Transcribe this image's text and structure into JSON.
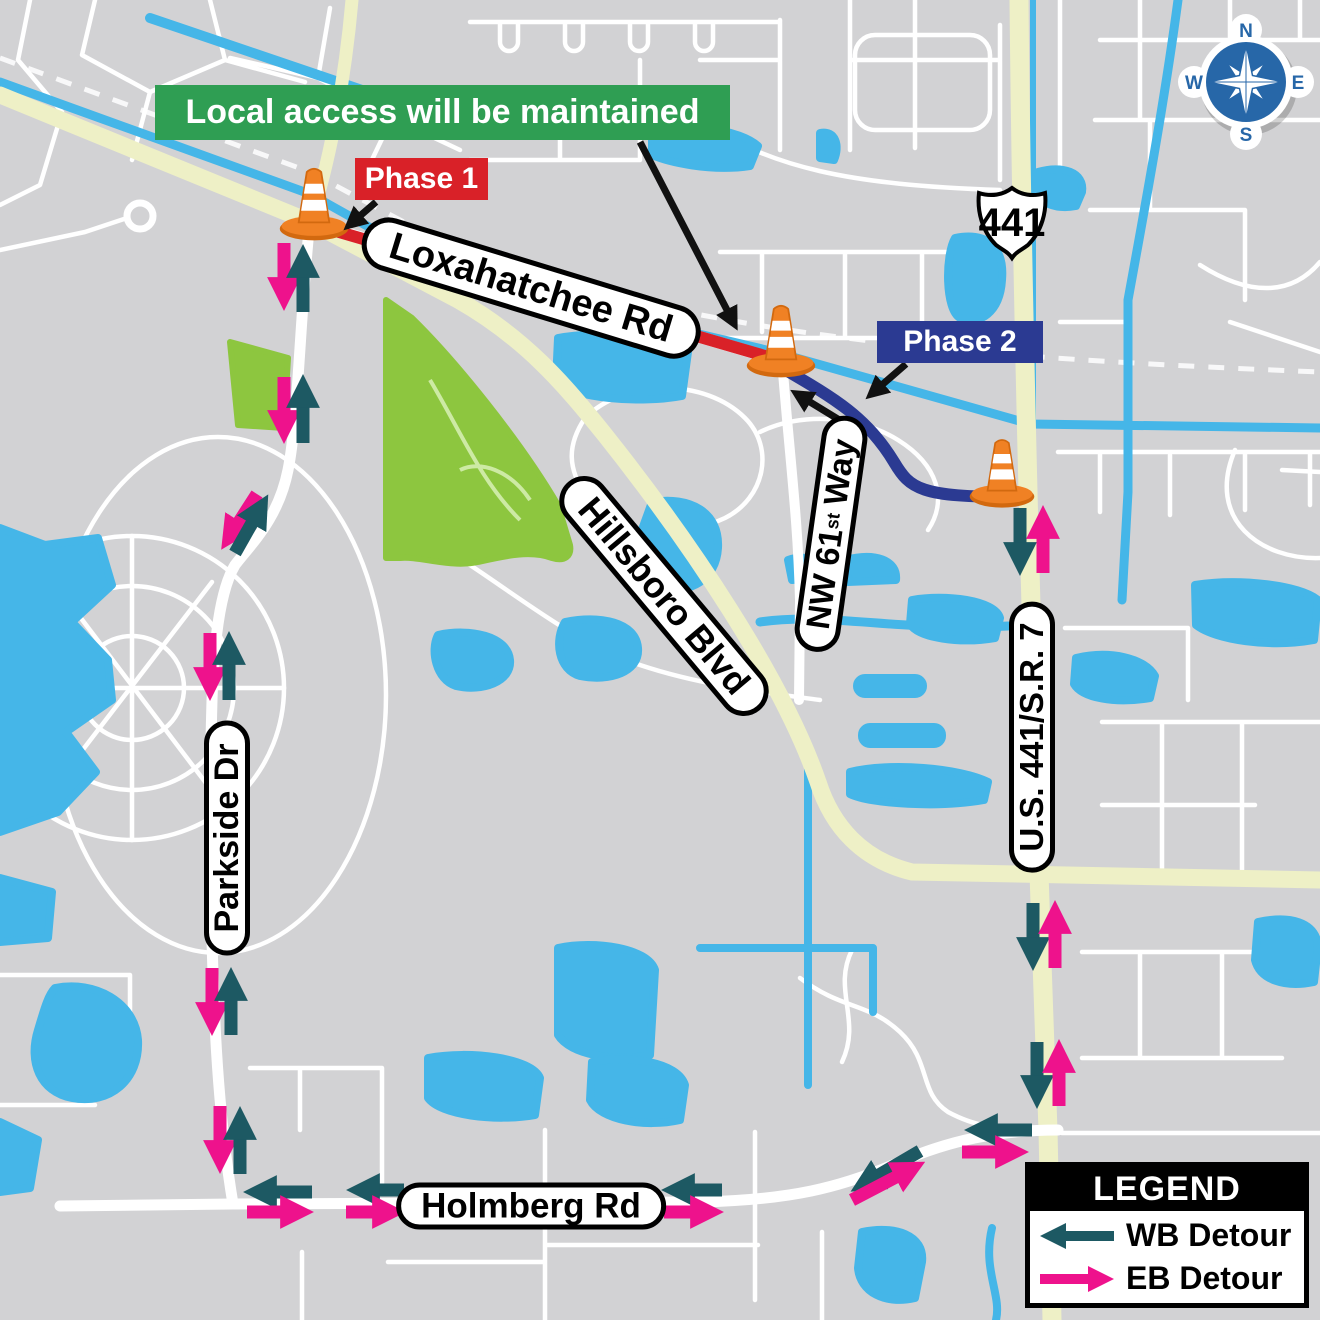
{
  "banners": {
    "local_access": "Local access will be maintained",
    "phase1": "Phase 1",
    "phase2": "Phase 2"
  },
  "roads": {
    "loxahatchee": "Loxahatchee Rd",
    "hillsboro": "Hillsboro Blvd",
    "nw61_prefix": "NW 61",
    "nw61_superscript": "st",
    "nw61_suffix": "Way",
    "parkside": "Parkside Dr",
    "us441": "U.S. 441/S.R. 7",
    "holmberg": "Holmberg Rd"
  },
  "shield": {
    "route": "441"
  },
  "compass": {
    "north": "N",
    "east": "E",
    "south": "S",
    "west": "W"
  },
  "legend": {
    "title": "LEGEND",
    "wb_label": "WB Detour",
    "eb_label": "EB Detour"
  },
  "icons": {
    "cone": "traffic-cone-icon",
    "compass": "compass-rose-icon",
    "shield": "us-route-shield-icon"
  },
  "colors": {
    "wb_detour": "#1d5963",
    "eb_detour": "#ee128c",
    "phase1": "#d92128",
    "phase2": "#2b3a92",
    "local_access_banner": "#2f9e53",
    "water": "#45b6e8",
    "park": "#8dc63f",
    "major_road": "#eef0c6",
    "map_base": "#d2d2d4",
    "street": "#ffffff"
  }
}
